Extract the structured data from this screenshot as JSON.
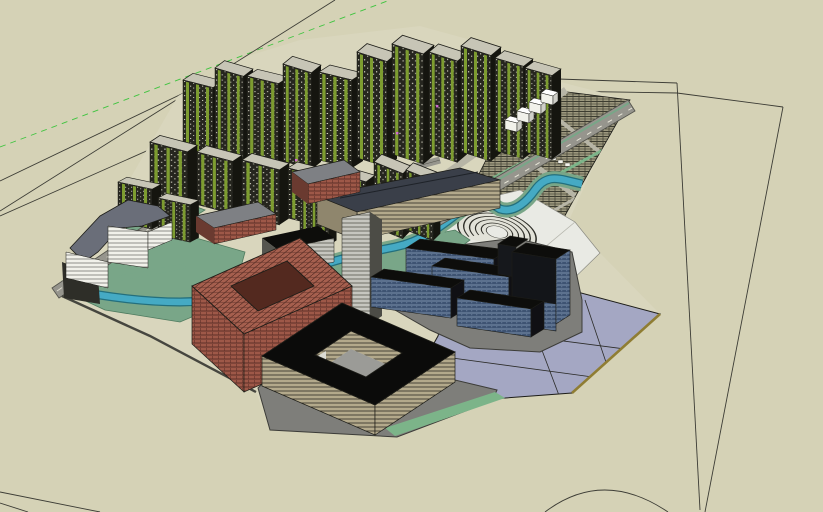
{
  "scene": {
    "app": "3d-model-viewport",
    "view": "aerial-axonometric-urban-master-plan",
    "colors": {
      "bg": "#d5d2b6",
      "site": "#d9d6bd",
      "line": "#1d1d18",
      "edgeShadow": "#46463f",
      "axisGreen": "#3ec43e",
      "road": "#96958d",
      "roadEdge": "#55554e",
      "roadLight": "#b7b5a6",
      "roadMedian": "#dedcce",
      "lawn": "#79a688",
      "lawnDark": "#4e7a5e",
      "tealRoof": "#5fae9e",
      "river": "#45aac4",
      "riverEdge": "#236f7d",
      "residDark": "#26261f",
      "residSpeck": "#d8d6c6",
      "balcony": "#7d9c30",
      "roofLight": "#c7c5b6",
      "slate": "#6a6e79",
      "slateDark": "#3a3f49",
      "whiteBldg": "#f1f1ea",
      "redWall": "#9e5848",
      "redDark": "#5e3028",
      "redTop": "#a55f4e",
      "tanWall": "#b3a98b",
      "tanDark": "#4a4538",
      "navy": "#3e5372",
      "navyLight": "#93a9c4",
      "blackish": "#0d0d0b",
      "lavender": "#a4a7c3",
      "gold": "#8f7d33",
      "plazaGray": "#7e7e7a",
      "plazaWhite": "#e9eae4",
      "hatchTan": "#c6bf9f",
      "hatchDark": "#3c3c30",
      "courtGray": "#9b9b97",
      "greenStrip": "#7cb489",
      "pink": "#d06ad0"
    },
    "elements": [
      {
        "name": "residential-tower-cluster"
      },
      {
        "name": "mid-rise-residential-row"
      },
      {
        "name": "red-courtyard-building"
      },
      {
        "name": "dark-courtyard-building"
      },
      {
        "name": "office-slab-cluster"
      },
      {
        "name": "terraced-horseshoe-building"
      },
      {
        "name": "stepped-slate-building"
      },
      {
        "name": "long-hip-roof-building"
      },
      {
        "name": "townhouse-district"
      },
      {
        "name": "river"
      },
      {
        "name": "lavender-plaza"
      },
      {
        "name": "main-roads"
      },
      {
        "name": "construction-guide-lines"
      },
      {
        "name": "green-axis-line"
      }
    ]
  }
}
